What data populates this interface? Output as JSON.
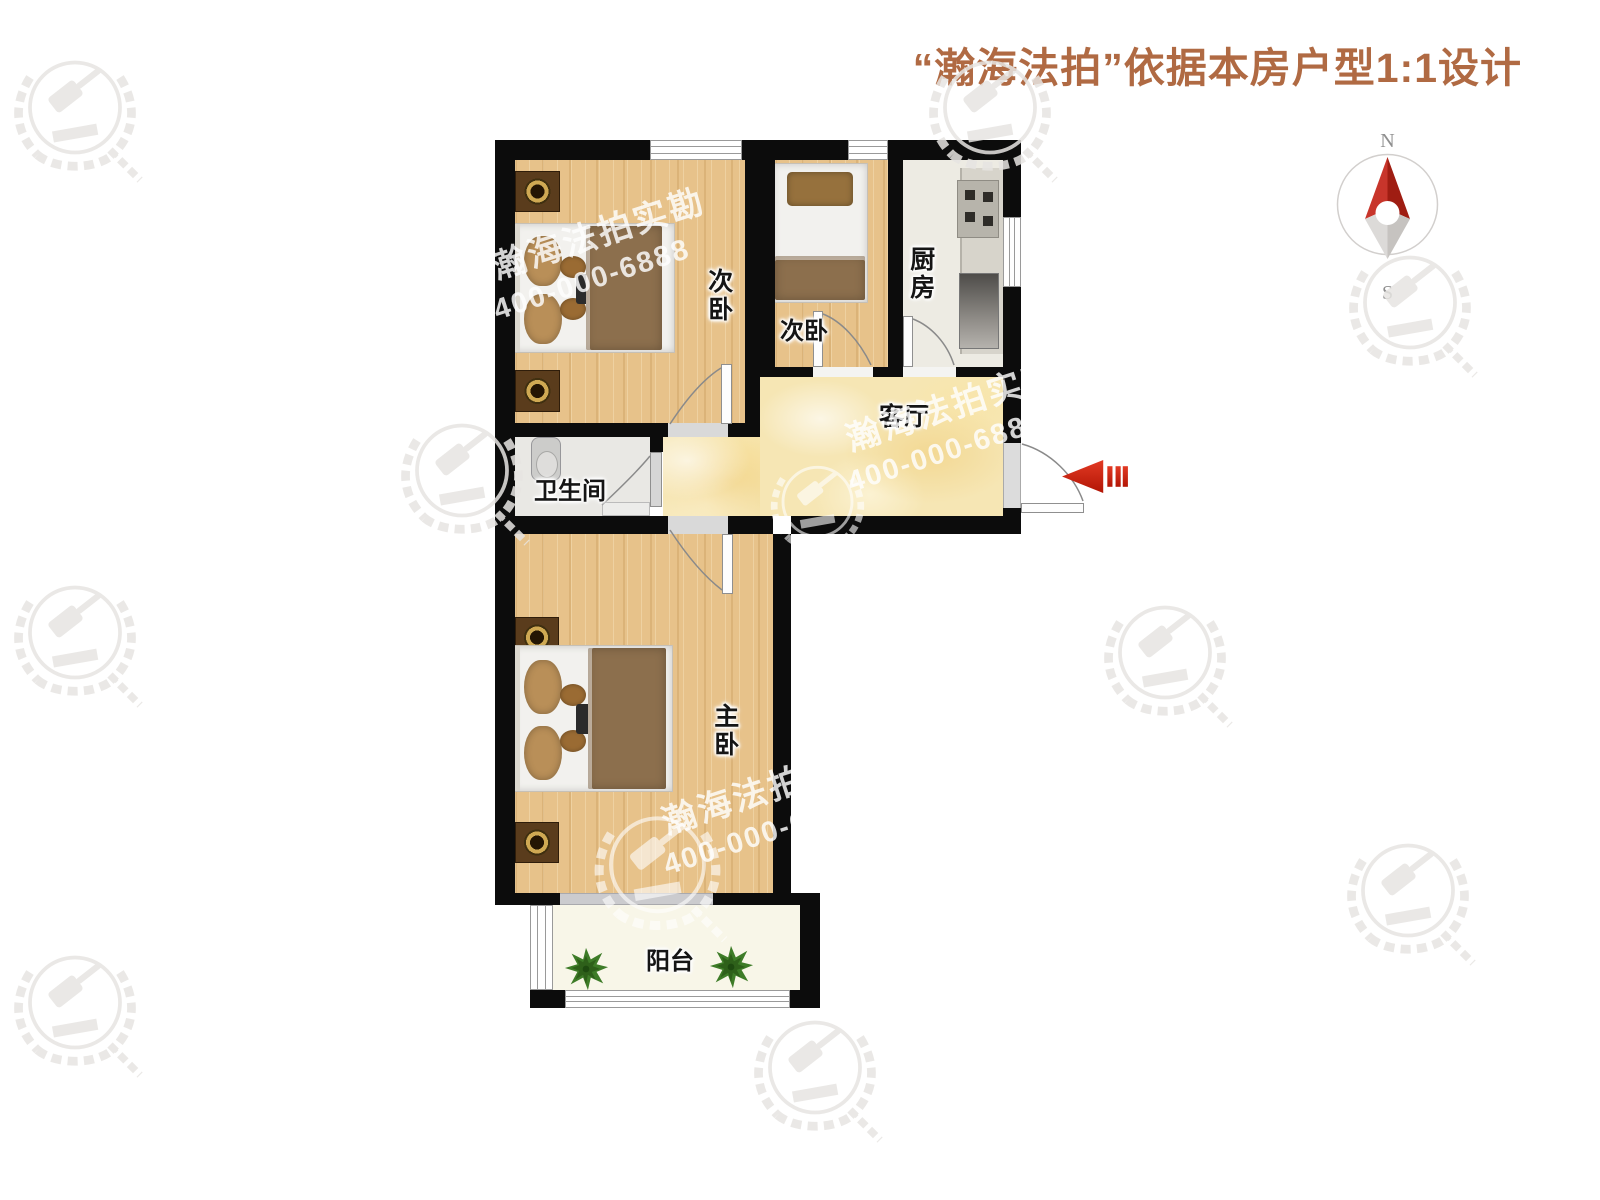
{
  "header": {
    "title": "“瀚海法拍”依据本房户型1:1设计"
  },
  "compass": {
    "north": "N",
    "south": "S"
  },
  "rooms": {
    "bedroom_top_left": {
      "label": "次卧"
    },
    "bedroom_top_mid": {
      "label": "次卧"
    },
    "kitchen": {
      "label": "厨房"
    },
    "living": {
      "label": "客厅"
    },
    "bathroom": {
      "label": "卫生间"
    },
    "master": {
      "label": "主卧"
    },
    "balcony": {
      "label": "阳台"
    }
  },
  "watermark": {
    "brand": "瀚海法拍实勘",
    "phone": "400-000-6888"
  },
  "colors": {
    "wall": "#0c0c0c",
    "wood_floor": "#e7c28a",
    "living_floor": "#f6e6b4",
    "kitchen_floor": "#edebe3",
    "bathroom_floor": "#e9e8e4",
    "balcony_floor": "#f8f6e8",
    "entry_arrow_red": "#c81e0e",
    "title_brown": "#b06a43"
  }
}
